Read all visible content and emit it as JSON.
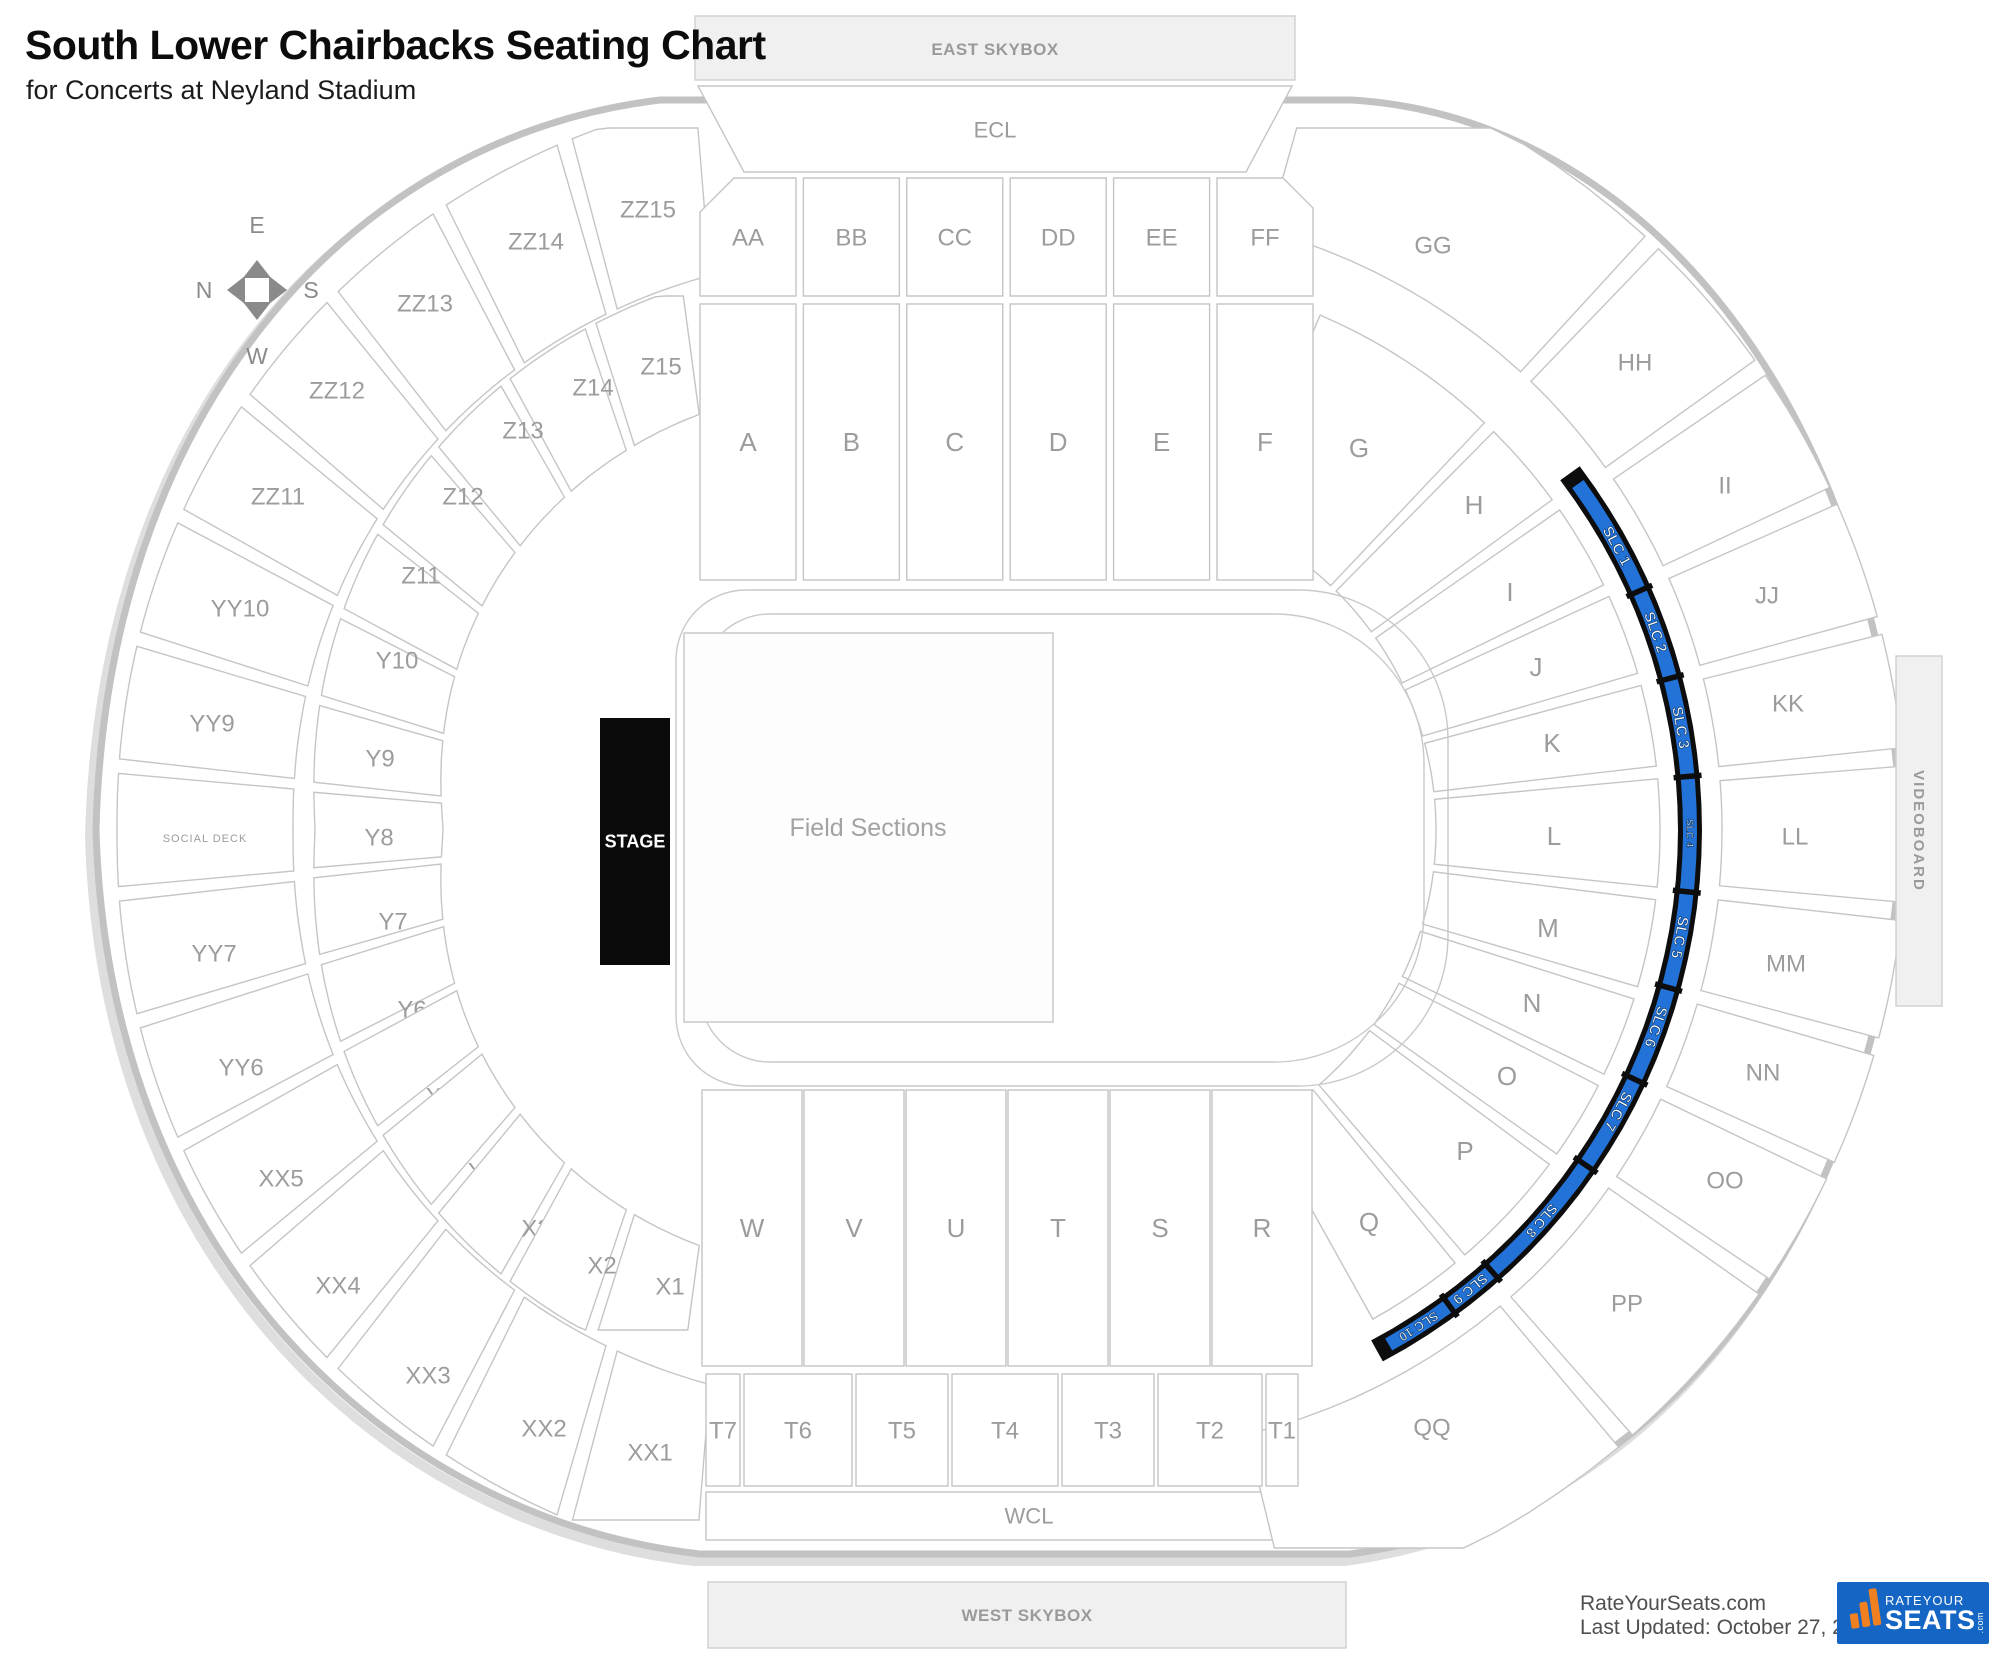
{
  "header": {
    "title": "South Lower Chairbacks Seating Chart",
    "subtitle": "for Concerts at Neyland Stadium"
  },
  "compass": {
    "top": "E",
    "left": "N",
    "right": "S",
    "bottom": "W"
  },
  "stadium": {
    "skybox_top": "EAST SKYBOX",
    "ecl": "ECL",
    "top_outer_row": [
      "AA",
      "BB",
      "CC",
      "DD",
      "EE",
      "FF"
    ],
    "top_inner_row": [
      "A",
      "B",
      "C",
      "D",
      "E",
      "F"
    ],
    "left_outer_ring": [
      "ZZ15",
      "ZZ14",
      "ZZ13",
      "ZZ12",
      "ZZ11",
      "YY10",
      "YY9",
      "SOCIAL DECK",
      "YY7",
      "YY6",
      "XX5",
      "XX4",
      "XX3",
      "XX2",
      "XX1"
    ],
    "left_inner_ring": [
      "Z15",
      "Z14",
      "Z13",
      "Z12",
      "Z11",
      "Y10",
      "Y9",
      "Y8",
      "Y7",
      "Y6",
      "X5",
      "X4",
      "X3",
      "X2",
      "X1"
    ],
    "right_outer_ring": [
      "GG",
      "HH",
      "II",
      "JJ",
      "KK",
      "LL",
      "MM",
      "NN",
      "OO",
      "PP",
      "QQ"
    ],
    "right_inner_ring": [
      "G",
      "H",
      "I",
      "J",
      "K",
      "L",
      "M",
      "N",
      "O",
      "P",
      "Q"
    ],
    "bottom_inner_row": [
      "W",
      "V",
      "U",
      "T",
      "S",
      "R"
    ],
    "bottom_outer_row": [
      "T7",
      "T6",
      "T5",
      "T4",
      "T3",
      "T2",
      "T1"
    ],
    "wcl": "WCL",
    "skybox_bottom": "WEST SKYBOX",
    "videoboard": "VIDEOBOARD",
    "field_label": "Field Sections",
    "stage_label": "STAGE",
    "highlight_sections": [
      "SLC 1",
      "SLC 2",
      "SLC 3",
      "SLC 4",
      "SLC 5",
      "SLC 6",
      "SLC 7",
      "SLC 8",
      "SLC 9",
      "SLC 10"
    ],
    "colors": {
      "highlight_blue": "#2272d8",
      "highlight_outline": "#0d0d0d",
      "section_stroke": "#c5c5c5",
      "bowl_stroke": "#c2c2c2",
      "label_gray": "#9c9c9c",
      "shade_fill": "#f0f0f0",
      "stage_black": "#0a0a0a"
    }
  },
  "footer": {
    "site": "RateYourSeats.com",
    "last_updated": "Last Updated: October 27, 2025",
    "logo": {
      "line1": "RATEYOUR",
      "line2": "SEATS",
      "line3": ".com",
      "bg": "#1566c4",
      "accent_orange": "#f08020"
    }
  }
}
